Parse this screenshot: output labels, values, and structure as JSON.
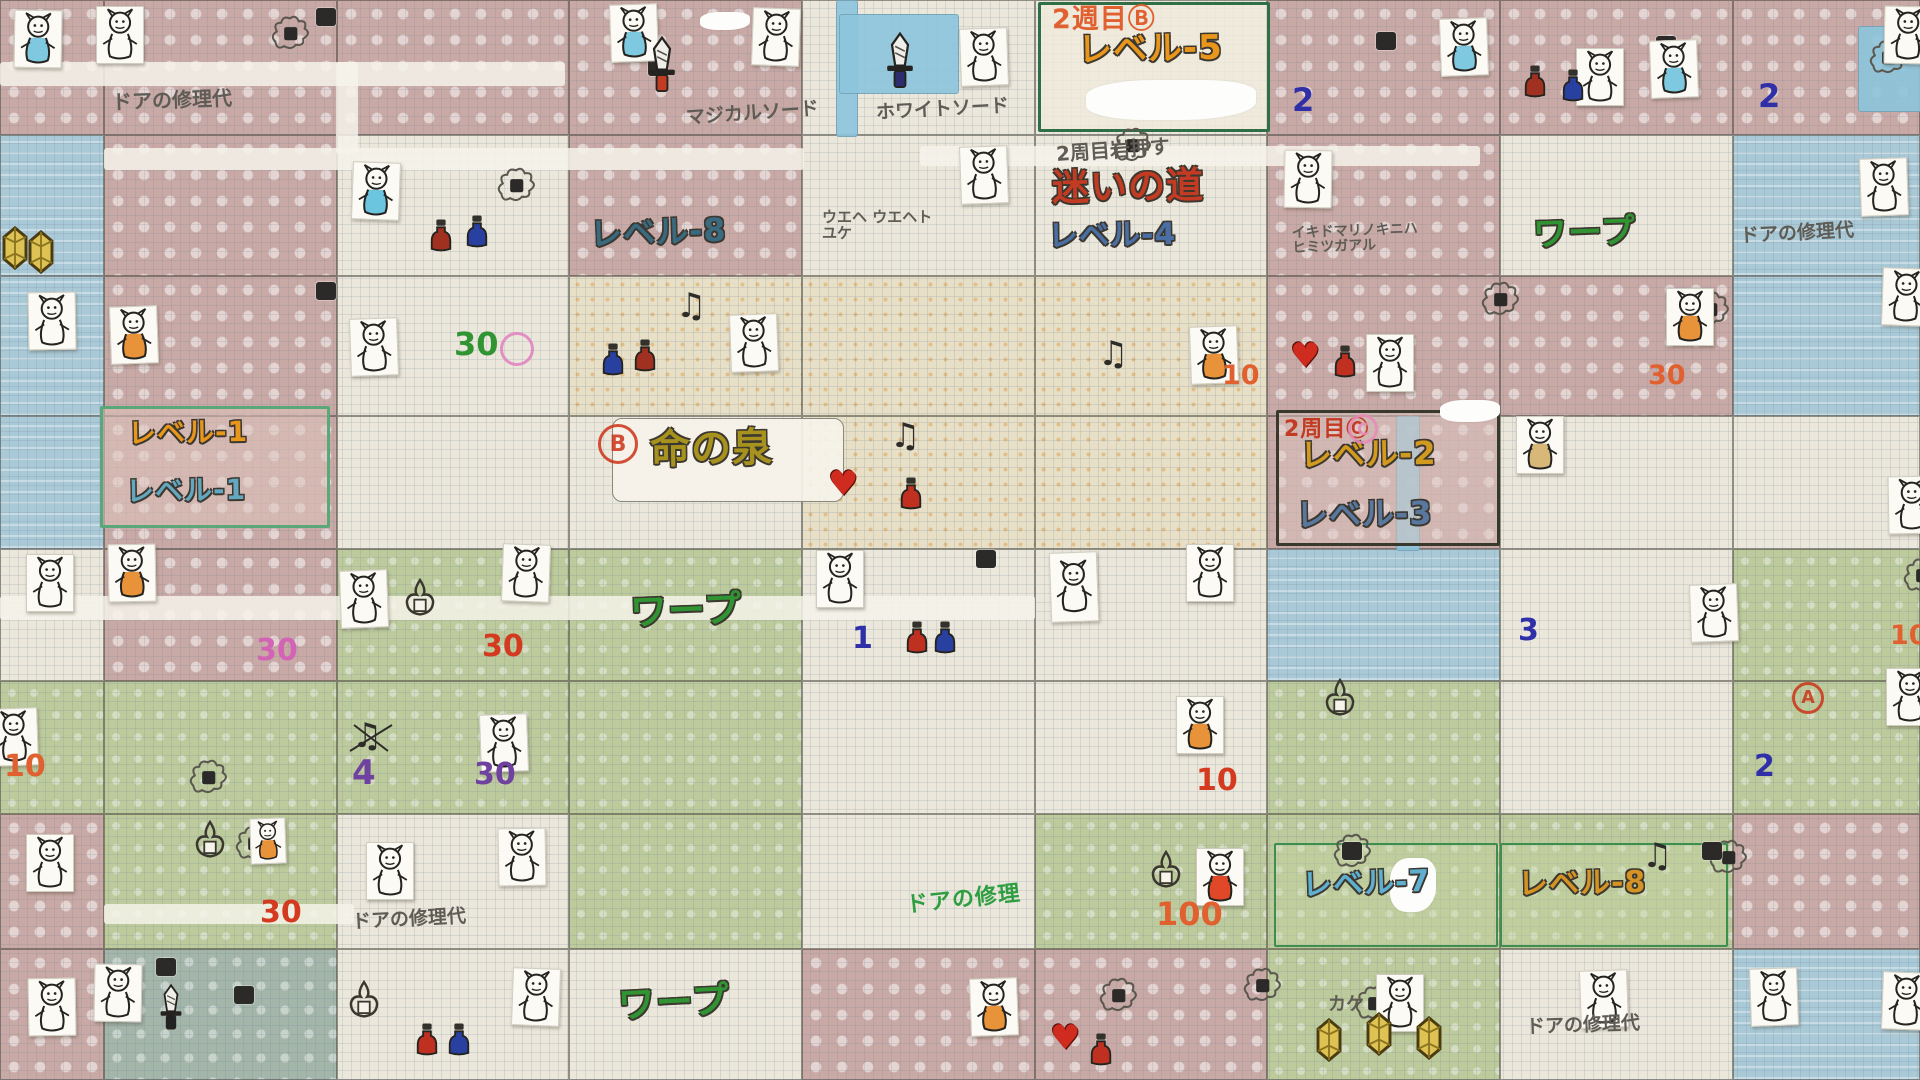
{
  "meta": {
    "description": "手描きゼルダの伝説オーバーワールド攻略マップ（方眼紙・スキャン）",
    "kind": "hand-drawn overworld strategy map"
  },
  "palette": {
    "pencil": "#5f5c55",
    "orange": "#e8971c",
    "crimson": "#c23b22",
    "blue": "#4a6fa5",
    "teal": "#3a6a80",
    "green": "#2f9431",
    "lightblue": "#64a8c0",
    "olive": "#a8921e",
    "gold": "#d39a20",
    "slate": "#5878a0",
    "red": "#d33a20",
    "magenta": "#d363b5",
    "purple": "#6f42a0",
    "green2": "#2e9e40",
    "lightblue2": "#5fb0d0",
    "orange2": "#d59324",
    "blue2": "#2f2fa8",
    "orangered": "#e06030",
    "terrain": {
      "P": "pink-path",
      "W": "cream-open",
      "G": "green-field",
      "B": "water",
      "S": "sand-desert",
      "T": "grey-rock"
    }
  },
  "grid": {
    "col_x": [
      0,
      104,
      337,
      569,
      802,
      1035,
      1267,
      1500,
      1733,
      1920
    ],
    "row_y": [
      0,
      135,
      276,
      416,
      549,
      681,
      814,
      949,
      1080
    ],
    "terrain": [
      [
        "P",
        "P",
        "P",
        "P",
        "W",
        "W",
        "P",
        "P",
        "P"
      ],
      [
        "B",
        "P",
        "W",
        "P",
        "W",
        "W",
        "P",
        "W",
        "B"
      ],
      [
        "B",
        "P",
        "W",
        "S",
        "S",
        "S",
        "P",
        "P",
        "B"
      ],
      [
        "B",
        "P",
        "W",
        "W",
        "S",
        "S",
        "P",
        "W",
        "W"
      ],
      [
        "W",
        "P",
        "G",
        "G",
        "W",
        "W",
        "B",
        "W",
        "G"
      ],
      [
        "G",
        "G",
        "G",
        "G",
        "W",
        "W",
        "G",
        "W",
        "G"
      ],
      [
        "P",
        "G",
        "W",
        "G",
        "W",
        "G",
        "G",
        "G",
        "P"
      ],
      [
        "P",
        "T",
        "W",
        "W",
        "P",
        "P",
        "G",
        "W",
        "B"
      ]
    ]
  },
  "bands": [
    {
      "x": 0,
      "y": 62,
      "w": 565,
      "h": 24,
      "c": "w"
    },
    {
      "x": 336,
      "y": 62,
      "w": 22,
      "h": 92,
      "c": "w"
    },
    {
      "x": 104,
      "y": 148,
      "w": 700,
      "h": 22,
      "c": "w"
    },
    {
      "x": 920,
      "y": 146,
      "w": 560,
      "h": 20,
      "c": "w"
    },
    {
      "x": 0,
      "y": 596,
      "w": 1035,
      "h": 24,
      "c": "w"
    },
    {
      "x": 104,
      "y": 904,
      "w": 250,
      "h": 20,
      "c": "w"
    },
    {
      "x": 836,
      "y": 0,
      "w": 20,
      "h": 135,
      "c": "b"
    },
    {
      "x": 839,
      "y": 14,
      "w": 118,
      "h": 78,
      "c": "b"
    },
    {
      "x": 1858,
      "y": 26,
      "w": 62,
      "h": 84,
      "c": "b"
    },
    {
      "x": 1396,
      "y": 416,
      "w": 22,
      "h": 133,
      "c": "b"
    }
  ],
  "boxes": [
    {
      "x": 1038,
      "y": 2,
      "w": 232,
      "h": 130,
      "bc": "#2f6e46",
      "bw": 3,
      "bg": "rgba(240,235,220,0.75)",
      "r": 2
    },
    {
      "x": 100,
      "y": 406,
      "w": 230,
      "h": 122,
      "bc": "#5aa87a",
      "bw": 3,
      "bg": "rgba(222,196,190,0.55)",
      "r": 2
    },
    {
      "x": 612,
      "y": 418,
      "w": 232,
      "h": 84,
      "bc": "#8a887c",
      "bw": 1.5,
      "bg": "rgba(246,243,234,0.92)",
      "r": 10
    },
    {
      "x": 1276,
      "y": 410,
      "w": 224,
      "h": 136,
      "bc": "#38382c",
      "bw": 3,
      "bg": "rgba(222,198,192,0.5)",
      "r": 2
    },
    {
      "x": 1274,
      "y": 843,
      "w": 224,
      "h": 104,
      "bc": "#3e8e4e",
      "bw": 2.5,
      "bg": "rgba(200,214,162,0.35)",
      "r": 2
    },
    {
      "x": 1500,
      "y": 843,
      "w": 228,
      "h": 104,
      "bc": "#3e8e4e",
      "bw": 2.5,
      "bg": "rgba(200,214,162,0.35)",
      "r": 2
    }
  ],
  "labels": [
    {
      "text": "ドアの修理代",
      "x": 112,
      "y": 90,
      "size": 20,
      "color": "pencil",
      "rot": -2,
      "pencil": true
    },
    {
      "text": "マジカルソード",
      "x": 686,
      "y": 104,
      "size": 19,
      "color": "pencil",
      "rot": -4,
      "pencil": true
    },
    {
      "text": "ホワイトソード",
      "x": 876,
      "y": 100,
      "size": 19,
      "color": "pencil",
      "rot": -3,
      "pencil": true
    },
    {
      "text": "2週目Ⓑ",
      "x": 1052,
      "y": 6,
      "size": 27,
      "color": "orangered",
      "rot": 0
    },
    {
      "text": "レベル-5",
      "x": 1078,
      "y": 32,
      "size": 34,
      "color": "orange",
      "outline": true,
      "rot": -1
    },
    {
      "text": "2",
      "x": 1292,
      "y": 84,
      "size": 32,
      "color": "blue2"
    },
    {
      "text": "2周目岩押す",
      "x": 1056,
      "y": 140,
      "size": 20,
      "color": "pencil",
      "rot": -4,
      "pencil": true
    },
    {
      "text": "迷いの道",
      "x": 1052,
      "y": 168,
      "size": 37,
      "color": "crimson",
      "outline": true,
      "rot": -1
    },
    {
      "text": "レベル-4",
      "x": 1048,
      "y": 220,
      "size": 30,
      "color": "blue",
      "outline": true,
      "rot": -1
    },
    {
      "text": "レベル-8",
      "x": 590,
      "y": 216,
      "size": 32,
      "color": "teal",
      "outline": true,
      "rot": -2
    },
    {
      "text": "ウエヘ ウエヘト\nユケ",
      "x": 822,
      "y": 210,
      "size": 15,
      "color": "pencil",
      "pencil": true
    },
    {
      "text": "ワープ",
      "x": 1533,
      "y": 216,
      "size": 34,
      "color": "green",
      "outline": true,
      "rot": -2
    },
    {
      "text": "ドアの修理代",
      "x": 1740,
      "y": 224,
      "size": 19,
      "color": "pencil",
      "rot": -3,
      "pencil": true
    },
    {
      "text": "イキドマリノキニハ\nヒミツガアル",
      "x": 1292,
      "y": 224,
      "size": 14,
      "color": "pencil",
      "rot": -2,
      "pencil": true
    },
    {
      "text": "2",
      "x": 1758,
      "y": 80,
      "size": 32,
      "color": "blue2"
    },
    {
      "text": "レベル-1",
      "x": 128,
      "y": 418,
      "size": 28,
      "color": "orange",
      "outline": true,
      "rot": -1
    },
    {
      "text": "レベル-1",
      "x": 126,
      "y": 476,
      "size": 28,
      "color": "lightblue",
      "outline": true,
      "rot": -1
    },
    {
      "text": "命の泉",
      "x": 650,
      "y": 428,
      "size": 40,
      "color": "olive",
      "outline": true,
      "rot": -1
    },
    {
      "text": "2周目Ⓒ",
      "x": 1284,
      "y": 418,
      "size": 22,
      "color": "crimson"
    },
    {
      "text": "レベル-2",
      "x": 1300,
      "y": 438,
      "size": 32,
      "color": "gold",
      "outline": true,
      "rot": -1
    },
    {
      "text": "レベル-3",
      "x": 1296,
      "y": 498,
      "size": 32,
      "color": "slate",
      "outline": true,
      "rot": -1
    },
    {
      "text": "ワープ",
      "x": 630,
      "y": 592,
      "size": 37,
      "color": "green",
      "outline": true,
      "rot": -2
    },
    {
      "text": "ドアの修理代",
      "x": 352,
      "y": 910,
      "size": 19,
      "color": "pencil",
      "rot": -3,
      "pencil": true
    },
    {
      "text": "ドアの修理",
      "x": 906,
      "y": 888,
      "size": 22,
      "color": "green2",
      "rot": -6
    },
    {
      "text": "レベル-7",
      "x": 1302,
      "y": 868,
      "size": 30,
      "color": "lightblue2",
      "outline": true,
      "rot": -2
    },
    {
      "text": "レベル-8",
      "x": 1518,
      "y": 868,
      "size": 30,
      "color": "orange2",
      "outline": true,
      "rot": -1
    },
    {
      "text": "ワープ",
      "x": 618,
      "y": 984,
      "size": 37,
      "color": "green",
      "outline": true,
      "rot": -3
    },
    {
      "text": "カケ",
      "x": 1328,
      "y": 996,
      "size": 18,
      "color": "pencil",
      "pencil": true
    },
    {
      "text": "ドアの修理代",
      "x": 1526,
      "y": 1016,
      "size": 19,
      "color": "pencil",
      "rot": -2,
      "pencil": true
    }
  ],
  "numbers": [
    {
      "text": "30",
      "x": 454,
      "y": 328,
      "c": "green",
      "s": 32
    },
    {
      "text": "10",
      "x": 1222,
      "y": 362,
      "c": "orangered",
      "s": 27
    },
    {
      "text": "30",
      "x": 1648,
      "y": 362,
      "c": "orangered",
      "s": 27
    },
    {
      "text": "30",
      "x": 256,
      "y": 636,
      "c": "magenta",
      "s": 30
    },
    {
      "text": "30",
      "x": 482,
      "y": 632,
      "c": "red",
      "s": 30
    },
    {
      "text": "1",
      "x": 852,
      "y": 624,
      "c": "blue2",
      "s": 30
    },
    {
      "text": "3",
      "x": 1518,
      "y": 616,
      "c": "blue2",
      "s": 30
    },
    {
      "text": "10",
      "x": 4,
      "y": 752,
      "c": "orangered",
      "s": 30
    },
    {
      "text": "4",
      "x": 352,
      "y": 756,
      "c": "purple",
      "s": 34
    },
    {
      "text": "30",
      "x": 474,
      "y": 760,
      "c": "purple",
      "s": 30
    },
    {
      "text": "10",
      "x": 1196,
      "y": 766,
      "c": "red",
      "s": 30
    },
    {
      "text": "2",
      "x": 1754,
      "y": 752,
      "c": "blue2",
      "s": 30
    },
    {
      "text": "30",
      "x": 260,
      "y": 898,
      "c": "red",
      "s": 30
    },
    {
      "text": "100",
      "x": 1156,
      "y": 898,
      "c": "orangered",
      "s": 32
    },
    {
      "text": "10",
      "x": 1890,
      "y": 622,
      "c": "orangered",
      "s": 27
    }
  ],
  "stamps": [
    {
      "letter": "B",
      "x": 598,
      "y": 424,
      "d": 40,
      "c": "#cc3318"
    },
    {
      "letter": "A",
      "x": 1792,
      "y": 682,
      "d": 32,
      "c": "#cc3318"
    },
    {
      "letter": "",
      "x": 500,
      "y": 332,
      "d": 34,
      "c": "#e080c0"
    },
    {
      "letter": "C",
      "x": 1348,
      "y": 414,
      "d": 30,
      "c": "#e88bb8"
    }
  ],
  "stickers": [
    {
      "x": 14,
      "y": 10,
      "t": "blue"
    },
    {
      "x": 96,
      "y": 6,
      "t": "none"
    },
    {
      "x": 610,
      "y": 4,
      "t": "blue"
    },
    {
      "x": 752,
      "y": 8,
      "t": "none"
    },
    {
      "x": 960,
      "y": 28,
      "t": "none"
    },
    {
      "x": 1440,
      "y": 18,
      "t": "blue"
    },
    {
      "x": 1576,
      "y": 48,
      "t": "none"
    },
    {
      "x": 1650,
      "y": 40,
      "t": "blue"
    },
    {
      "x": 1884,
      "y": 6,
      "t": "none"
    },
    {
      "x": 352,
      "y": 162,
      "t": "cyan"
    },
    {
      "x": 960,
      "y": 146,
      "t": "none"
    },
    {
      "x": 1284,
      "y": 150,
      "t": "none"
    },
    {
      "x": 1860,
      "y": 158,
      "t": "none"
    },
    {
      "x": 28,
      "y": 292,
      "t": "none"
    },
    {
      "x": 110,
      "y": 306,
      "t": "orange"
    },
    {
      "x": 350,
      "y": 318,
      "t": "none"
    },
    {
      "x": 730,
      "y": 314,
      "t": "none"
    },
    {
      "x": 1190,
      "y": 326,
      "t": "orange"
    },
    {
      "x": 1366,
      "y": 334,
      "t": "none"
    },
    {
      "x": 1666,
      "y": 288,
      "t": "orange"
    },
    {
      "x": 1882,
      "y": 268,
      "t": "none"
    },
    {
      "x": 1516,
      "y": 416,
      "t": "tan"
    },
    {
      "x": 1888,
      "y": 476,
      "t": "none"
    },
    {
      "x": 26,
      "y": 554,
      "t": "none"
    },
    {
      "x": 108,
      "y": 544,
      "t": "orange"
    },
    {
      "x": 340,
      "y": 570,
      "t": "none"
    },
    {
      "x": 502,
      "y": 544,
      "t": "none"
    },
    {
      "x": 816,
      "y": 550,
      "t": "none"
    },
    {
      "x": 1050,
      "y": 552,
      "t": "none",
      "h": 68
    },
    {
      "x": 1186,
      "y": 544,
      "t": "none"
    },
    {
      "x": 1690,
      "y": 584,
      "t": "none"
    },
    {
      "x": -10,
      "y": 708,
      "t": "none"
    },
    {
      "x": 480,
      "y": 714,
      "t": "none"
    },
    {
      "x": 1176,
      "y": 696,
      "t": "orange"
    },
    {
      "x": 1886,
      "y": 668,
      "t": "none"
    },
    {
      "x": 26,
      "y": 834,
      "t": "none"
    },
    {
      "x": 250,
      "y": 818,
      "t": "orange",
      "w": 34,
      "h": 44
    },
    {
      "x": 366,
      "y": 842,
      "t": "none"
    },
    {
      "x": 498,
      "y": 828,
      "t": "none"
    },
    {
      "x": 1196,
      "y": 848,
      "t": "red"
    },
    {
      "x": 28,
      "y": 978,
      "t": "none"
    },
    {
      "x": 94,
      "y": 964,
      "t": "none"
    },
    {
      "x": 512,
      "y": 968,
      "t": "none"
    },
    {
      "x": 970,
      "y": 978,
      "t": "orange"
    },
    {
      "x": 1376,
      "y": 974,
      "t": "none"
    },
    {
      "x": 1580,
      "y": 970,
      "t": "none"
    },
    {
      "x": 1750,
      "y": 968,
      "t": "none"
    },
    {
      "x": 1882,
      "y": 972,
      "t": "none"
    }
  ],
  "smokes": [
    {
      "x": 268,
      "y": 14
    },
    {
      "x": 494,
      "y": 166
    },
    {
      "x": 1110,
      "y": 126
    },
    {
      "x": 1478,
      "y": 280
    },
    {
      "x": 1688,
      "y": 290
    },
    {
      "x": 186,
      "y": 758
    },
    {
      "x": 232,
      "y": 824
    },
    {
      "x": 1330,
      "y": 832
    },
    {
      "x": 1096,
      "y": 976
    },
    {
      "x": 1240,
      "y": 966
    },
    {
      "x": 1352,
      "y": 984
    },
    {
      "x": 1866,
      "y": 38
    },
    {
      "x": 1706,
      "y": 838
    },
    {
      "x": 1900,
      "y": 556
    }
  ],
  "doors": [
    {
      "x": 316,
      "y": 8
    },
    {
      "x": 648,
      "y": 58
    },
    {
      "x": 1376,
      "y": 32
    },
    {
      "x": 1656,
      "y": 36
    },
    {
      "x": 316,
      "y": 282
    },
    {
      "x": 976,
      "y": 550
    },
    {
      "x": 156,
      "y": 958
    },
    {
      "x": 234,
      "y": 986
    },
    {
      "x": 1342,
      "y": 842
    },
    {
      "x": 1702,
      "y": 842
    },
    {
      "x": 1896,
      "y": 686
    }
  ],
  "whiteouts": [
    {
      "x": 1086,
      "y": 80,
      "w": 170,
      "h": 40
    },
    {
      "x": 1390,
      "y": 858,
      "w": 46,
      "h": 54
    },
    {
      "x": 1440,
      "y": 400,
      "w": 60,
      "h": 22
    },
    {
      "x": 700,
      "y": 12,
      "w": 50,
      "h": 18
    }
  ],
  "items": [
    {
      "t": "sword",
      "x": 646,
      "y": 36,
      "c": "#c23b22",
      "s": 1.6,
      "name": "magical-sword"
    },
    {
      "t": "sword",
      "x": 884,
      "y": 32,
      "c": "#2c2c6e",
      "s": 1.6,
      "name": "white-sword"
    },
    {
      "t": "sword",
      "x": 158,
      "y": 984,
      "c": "#222222",
      "s": 1.3,
      "name": "black-sword"
    },
    {
      "t": "crystal",
      "x": 0,
      "y": 226
    },
    {
      "t": "crystal",
      "x": 26,
      "y": 230
    },
    {
      "t": "crystal",
      "x": 1314,
      "y": 1018
    },
    {
      "t": "crystal",
      "x": 1364,
      "y": 1012
    },
    {
      "t": "crystal",
      "x": 1414,
      "y": 1016
    },
    {
      "t": "note",
      "x": 676,
      "y": 286
    },
    {
      "t": "note",
      "x": 890,
      "y": 416
    },
    {
      "t": "note",
      "x": 1098,
      "y": 334
    },
    {
      "t": "note",
      "x": 1642,
      "y": 836
    },
    {
      "t": "note-x",
      "x": 352,
      "y": 716
    },
    {
      "t": "heart",
      "x": 828,
      "y": 464
    },
    {
      "t": "heart",
      "x": 1290,
      "y": 336
    },
    {
      "t": "heart",
      "x": 1050,
      "y": 1018
    },
    {
      "t": "potion",
      "x": 430,
      "y": 218,
      "c": "#a03020"
    },
    {
      "t": "potion",
      "x": 466,
      "y": 214,
      "c": "#2840a0"
    },
    {
      "t": "potion",
      "x": 602,
      "y": 342,
      "c": "#2840a0"
    },
    {
      "t": "potion",
      "x": 634,
      "y": 338,
      "c": "#a03020"
    },
    {
      "t": "potion",
      "x": 1524,
      "y": 64,
      "c": "#a03020"
    },
    {
      "t": "potion",
      "x": 1562,
      "y": 68,
      "c": "#2840a0"
    },
    {
      "t": "potion",
      "x": 900,
      "y": 476,
      "c": "#c03020"
    },
    {
      "t": "potion",
      "x": 906,
      "y": 620,
      "c": "#c03020"
    },
    {
      "t": "potion",
      "x": 934,
      "y": 620,
      "c": "#2840a0"
    },
    {
      "t": "potion",
      "x": 1334,
      "y": 344,
      "c": "#c03020"
    },
    {
      "t": "potion",
      "x": 416,
      "y": 1022,
      "c": "#c03020"
    },
    {
      "t": "potion",
      "x": 448,
      "y": 1022,
      "c": "#2840a0"
    },
    {
      "t": "potion",
      "x": 1090,
      "y": 1032,
      "c": "#c03020"
    },
    {
      "t": "fire",
      "x": 192,
      "y": 820
    },
    {
      "t": "fire",
      "x": 402,
      "y": 578
    },
    {
      "t": "fire",
      "x": 1148,
      "y": 850
    },
    {
      "t": "fire",
      "x": 346,
      "y": 980
    },
    {
      "t": "fire",
      "x": 1322,
      "y": 678
    }
  ]
}
